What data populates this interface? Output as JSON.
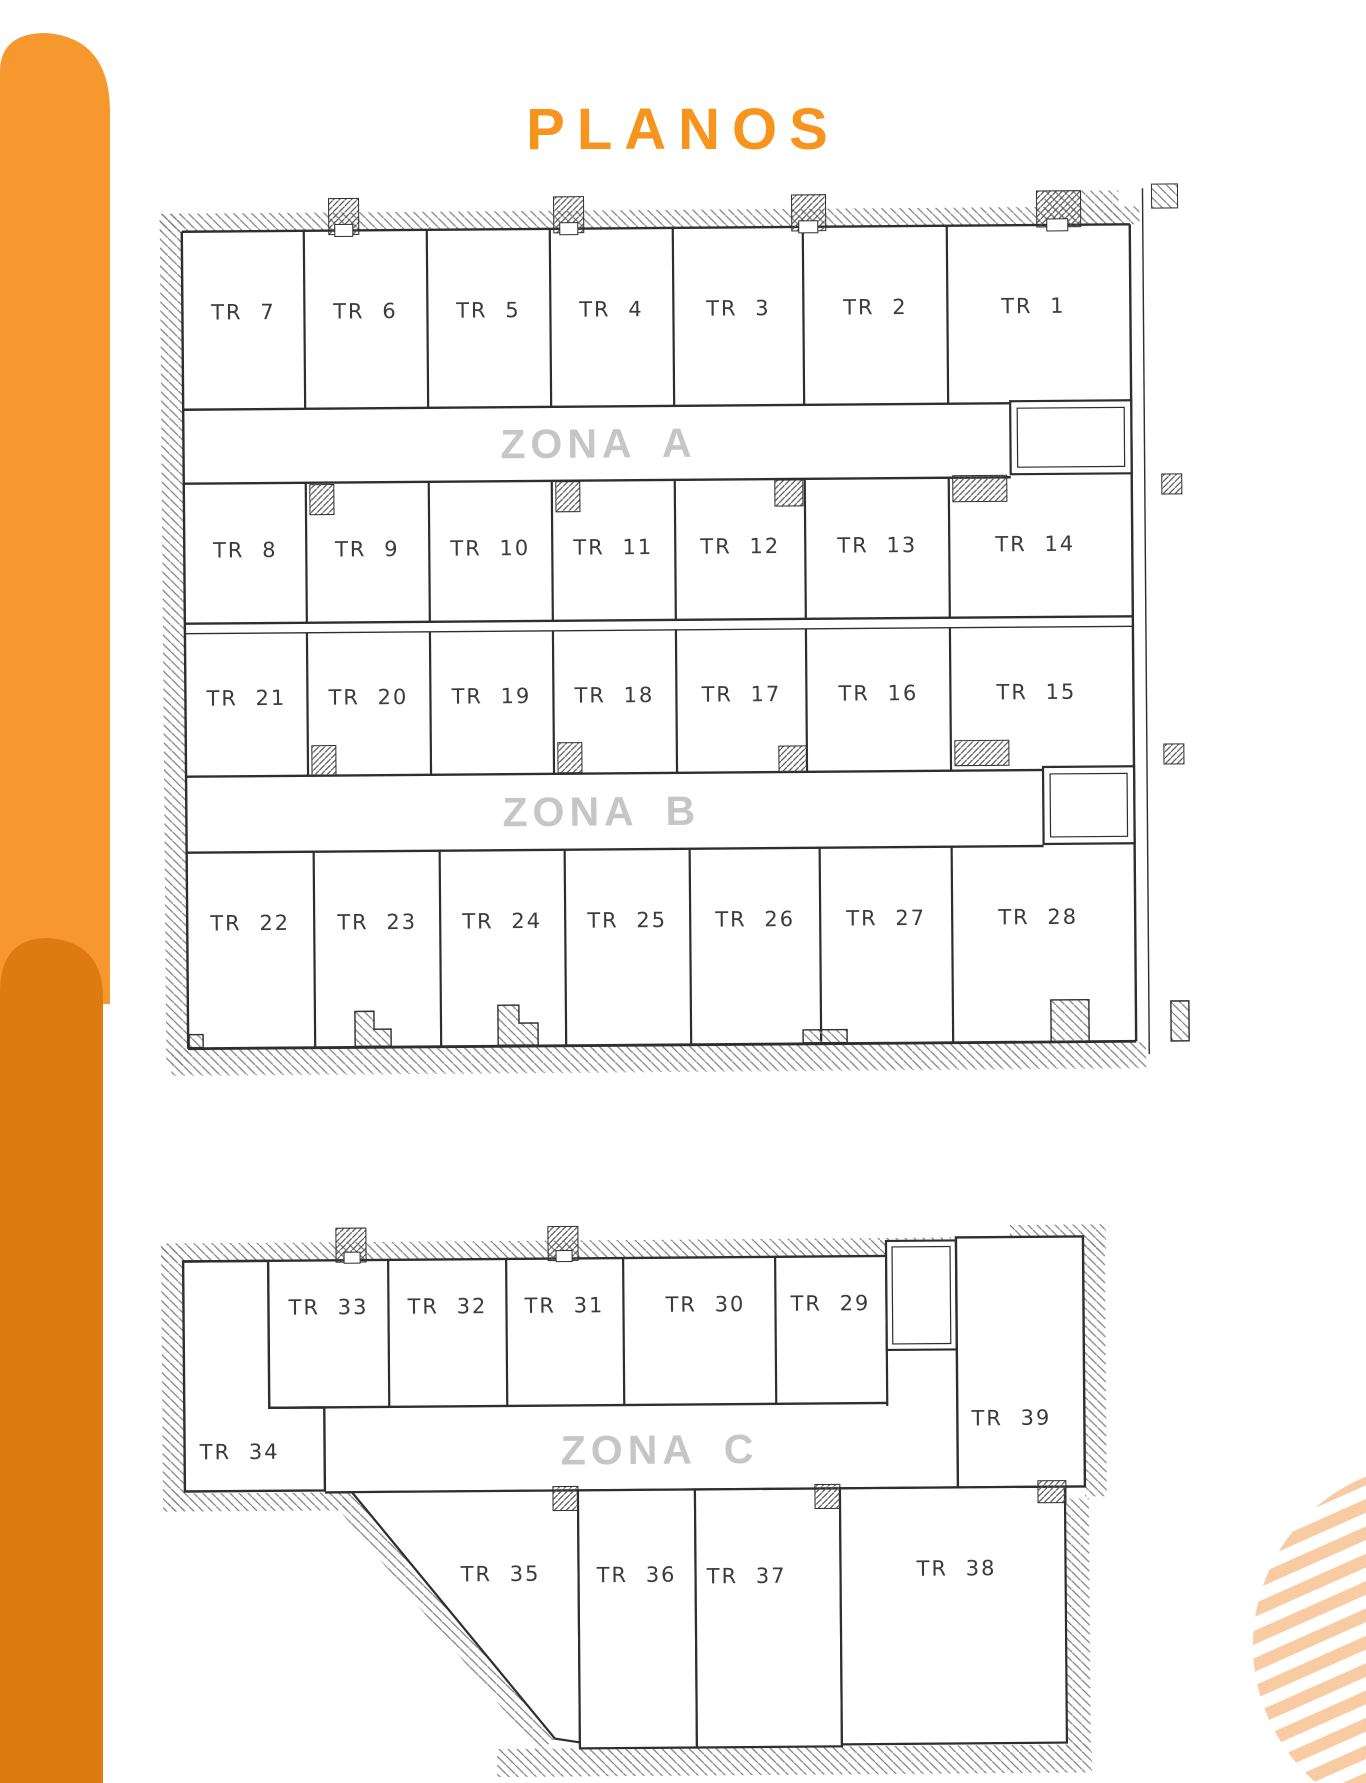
{
  "page": {
    "title": "PLANOS"
  },
  "zones": {
    "a": "ZONA A",
    "b": "ZONA B",
    "c": "ZONA C"
  },
  "plan_upper": {
    "row1": [
      "TR 7",
      "TR 6",
      "TR 5",
      "TR 4",
      "TR 3",
      "TR 2",
      "TR 1"
    ],
    "row2": [
      "TR 8",
      "TR 9",
      "TR 10",
      "TR 11",
      "TR 12",
      "TR 13",
      "TR 14"
    ],
    "row3": [
      "TR 21",
      "TR 20",
      "TR 19",
      "TR 18",
      "TR 17",
      "TR 16",
      "TR 15"
    ],
    "row4": [
      "TR 22",
      "TR 23",
      "TR 24",
      "TR 25",
      "TR 26",
      "TR 27",
      "TR 28"
    ]
  },
  "plan_lower": {
    "row_top": [
      "TR 33",
      "TR 32",
      "TR 31",
      "TR 30",
      "TR 29"
    ],
    "left_unit": "TR 34",
    "right_unit": "TR 39",
    "row_bottom": [
      "TR 35",
      "TR 36",
      "TR 37",
      "TR 38"
    ]
  },
  "colors": {
    "accent": "#F7941D",
    "accent_dark": "#DE7B10",
    "accent_light": "#F6982E",
    "stripe": "#F8CBA2",
    "zone_label": "#C6C6C6",
    "wall": "#2E2E2E"
  }
}
